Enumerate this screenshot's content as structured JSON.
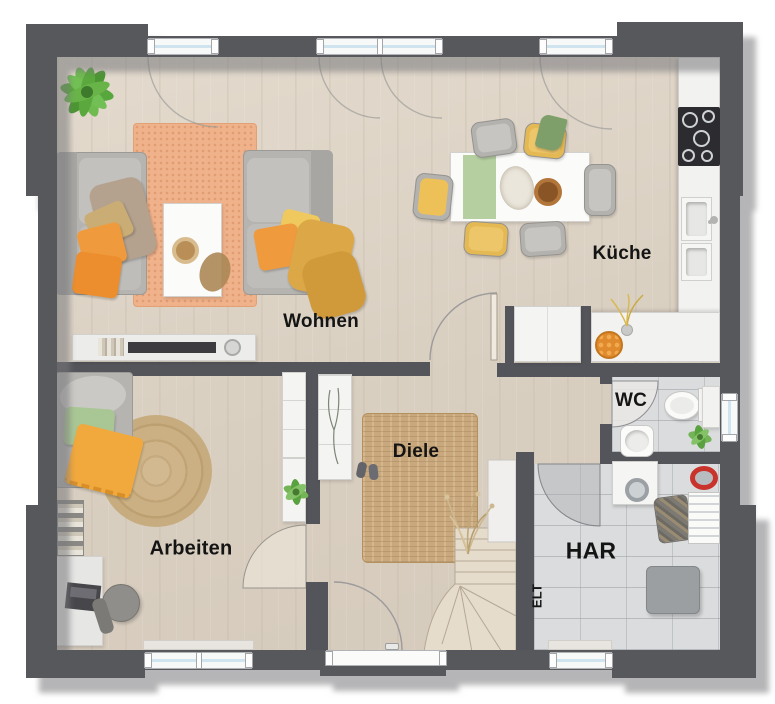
{
  "rooms": {
    "wohnen": {
      "label": "Wohnen"
    },
    "kueche": {
      "label": "Küche"
    },
    "arbeiten": {
      "label": "Arbeiten"
    },
    "diele": {
      "label": "Diele"
    },
    "wc": {
      "label": "WC"
    },
    "har": {
      "label": "HAR"
    },
    "elt": {
      "label": "ELT"
    }
  },
  "colors": {
    "wall": "#57585c",
    "floor_wood": "#dcd2c5",
    "floor_tile": "#dadcdd",
    "rug_orange": "#efb28b",
    "rug_jute": "#c9a87d",
    "stair_wood": "#e6dccc",
    "accent_orange": "#f09a3e",
    "accent_yellow": "#eec455",
    "accent_green": "#a9c795",
    "counter_white": "#f2f2f0",
    "window_glass": "#cfe4ef"
  }
}
